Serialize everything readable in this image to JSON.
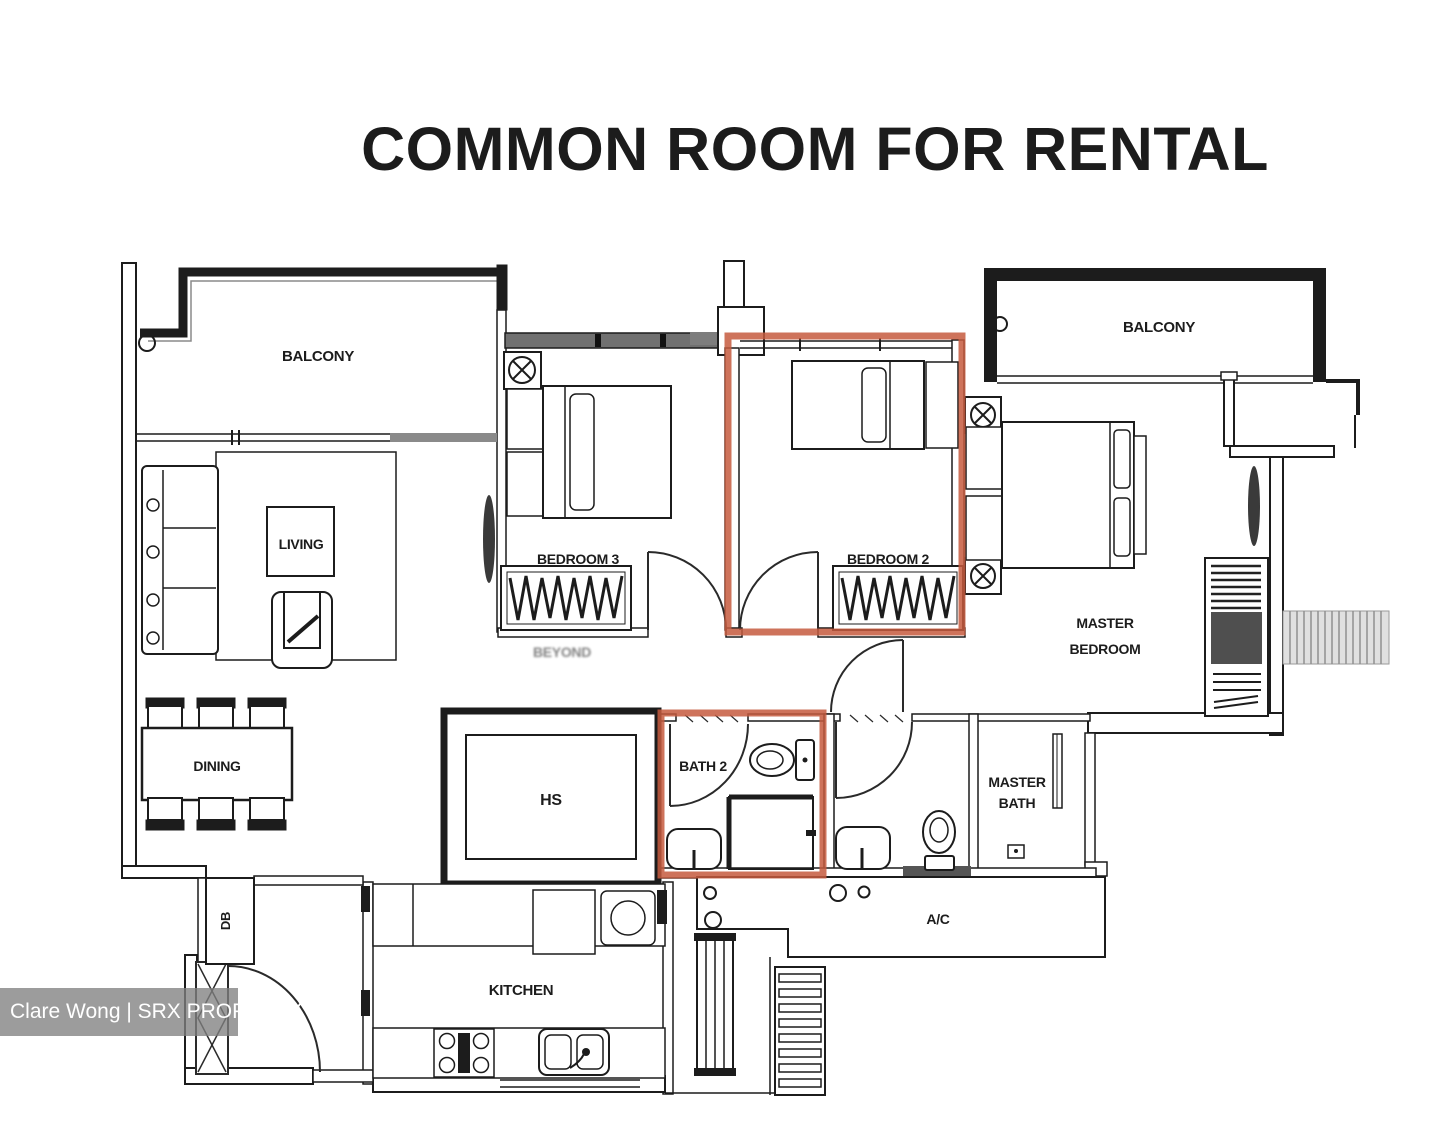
{
  "title": {
    "text": "COMMON ROOM FOR RENTAL",
    "color": "#cb5b36"
  },
  "watermark": {
    "text": "Clare Wong | SRX PROPERTY"
  },
  "colors": {
    "highlight": "#c65a3e"
  },
  "labels": {
    "balcony_left": "BALCONY",
    "balcony_right": "BALCONY",
    "living": "LIVING",
    "dining": "DINING",
    "db": "DB",
    "bedroom3": "BEDROOM 3",
    "bedroom2": "BEDROOM 2",
    "master_bedroom_line1": "MASTER",
    "master_bedroom_line2": "BEDROOM",
    "bath2": "BATH 2",
    "master_bath_line1": "MASTER",
    "master_bath_line2": "BATH",
    "hs": "HS",
    "kitchen": "KITCHEN",
    "ac": "A/C",
    "ghost": "BEYOND"
  }
}
